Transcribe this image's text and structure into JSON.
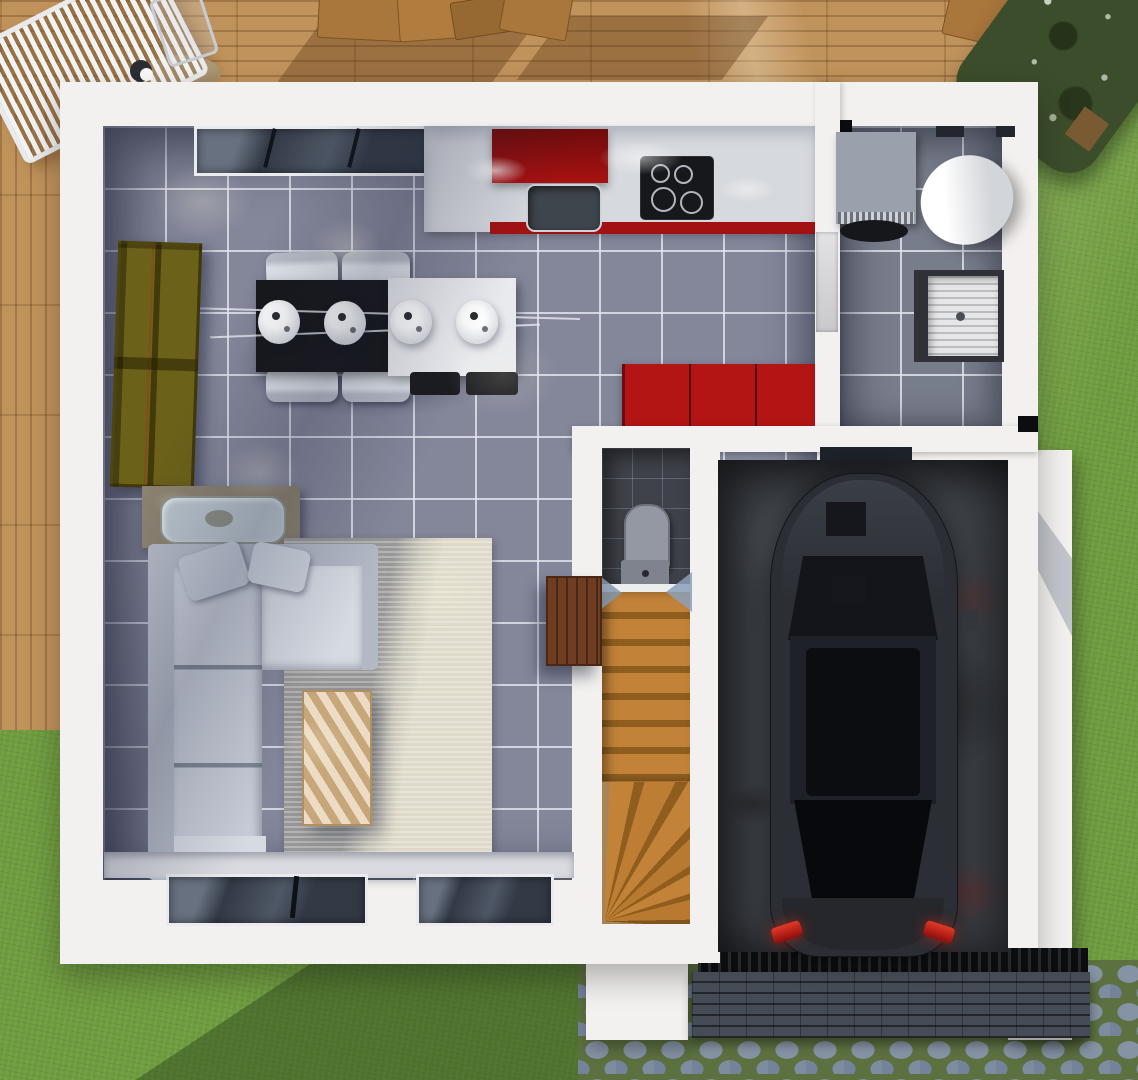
{
  "scene": {
    "type": "3d-architectural-floor-plan-render",
    "view": "top-down",
    "floor": "ground-floor"
  },
  "palette": {
    "deck_wood": "#c1935c",
    "grass": "#6f9c3f",
    "hedge_green": "#3c4d2b",
    "cobble_moss": "#5c7040",
    "wall_white": "#f2f1ef",
    "floor_tile": "#84879a",
    "utility_tile": "#787d8b",
    "wc_tile": "#3f424a",
    "counter_gray": "#d6d9de",
    "kitchen_red": "#a31212",
    "bench_red": "#b31414",
    "table_black": "#17181b",
    "table_white": "#e9eaee",
    "chair_white": "#dfe3e9",
    "shelf_olive": "#6c6119",
    "sofa_gray": "#c7ccd7",
    "sofa_light": "#d6dae2",
    "rug_cream": "#ded9c8",
    "pine_wood": "#dcc095",
    "sideboard_taupe": "#8b8170",
    "stair_wood": "#c28339",
    "cabinet_brown": "#6f3d22",
    "toilet_gray": "#9398a2",
    "washer_gray": "#9ba1ac",
    "heater_white": "#f4f4f4",
    "basin_white": "#e6e6e8",
    "concrete_dark": "#44484f",
    "car_black": "#2b2e34",
    "taillight_red": "#cc1616",
    "grate_black": "#191a1c",
    "brick_dark": "#3b4148",
    "window_glass": "#333a46",
    "door_panel": "#d9d9db"
  },
  "outdoor": {
    "areas": [
      "wood-deck-terrace",
      "lawn",
      "hedge-shrubs",
      "cobblestone-driveway",
      "brick-garage-apron"
    ],
    "furniture": [
      "white-slatted-lounge-chair",
      "folding-chair-frame",
      "parasol-table-top",
      "wooden-patio-table-set",
      "wooden-patio-chair"
    ]
  },
  "rooms": [
    {
      "name": "kitchen-dining",
      "floor": "gray-ceramic-tile",
      "items": [
        "kitchen-counter",
        "red-range-hood-cabinet",
        "kitchen-sink",
        "induction-cooktop-4-burners",
        "red-bench-cabinet",
        "dining-table-black-white",
        "dining-chair",
        "dining-chair",
        "dining-chair",
        "dining-chair",
        "pendant-lamp",
        "pendant-lamp",
        "pendant-lamp",
        "pendant-lamp",
        "olive-bookshelf",
        "top-wall-window",
        "kitchen-window"
      ]
    },
    {
      "name": "living-room",
      "floor": "gray-ceramic-tile",
      "items": [
        "sectional-sofa",
        "throw-pillow",
        "throw-pillow",
        "cream-rug",
        "pine-coffee-table",
        "sideboard-with-tray",
        "bottom-wall-window",
        "bottom-wall-window"
      ]
    },
    {
      "name": "wc",
      "floor": "dark-tile",
      "items": [
        "toilet"
      ]
    },
    {
      "name": "staircase",
      "items": [
        "straight-flight-steps",
        "winder-steps",
        "brown-storage-cabinet",
        "door-swing-marker",
        "door-swing-marker"
      ]
    },
    {
      "name": "utility-room",
      "floor": "gray-tile",
      "items": [
        "washing-machine",
        "water-heater-cylinder",
        "laundry-sink",
        "utility-door",
        "wall-vent",
        "wall-slot-window",
        "wall-slot-window"
      ]
    },
    {
      "name": "garage",
      "floor": "dark-concrete",
      "items": [
        "black-car-top-view",
        "car-windshield",
        "car-sunroof",
        "car-rear-window",
        "car-taillight",
        "car-taillight",
        "car-side-mirror",
        "car-side-mirror",
        "garage-slit-window",
        "entrance-grate"
      ]
    }
  ],
  "counts": {
    "dining_chairs": 4,
    "pendant_lamps": 4,
    "bottom_windows": 2,
    "cars": 1
  }
}
